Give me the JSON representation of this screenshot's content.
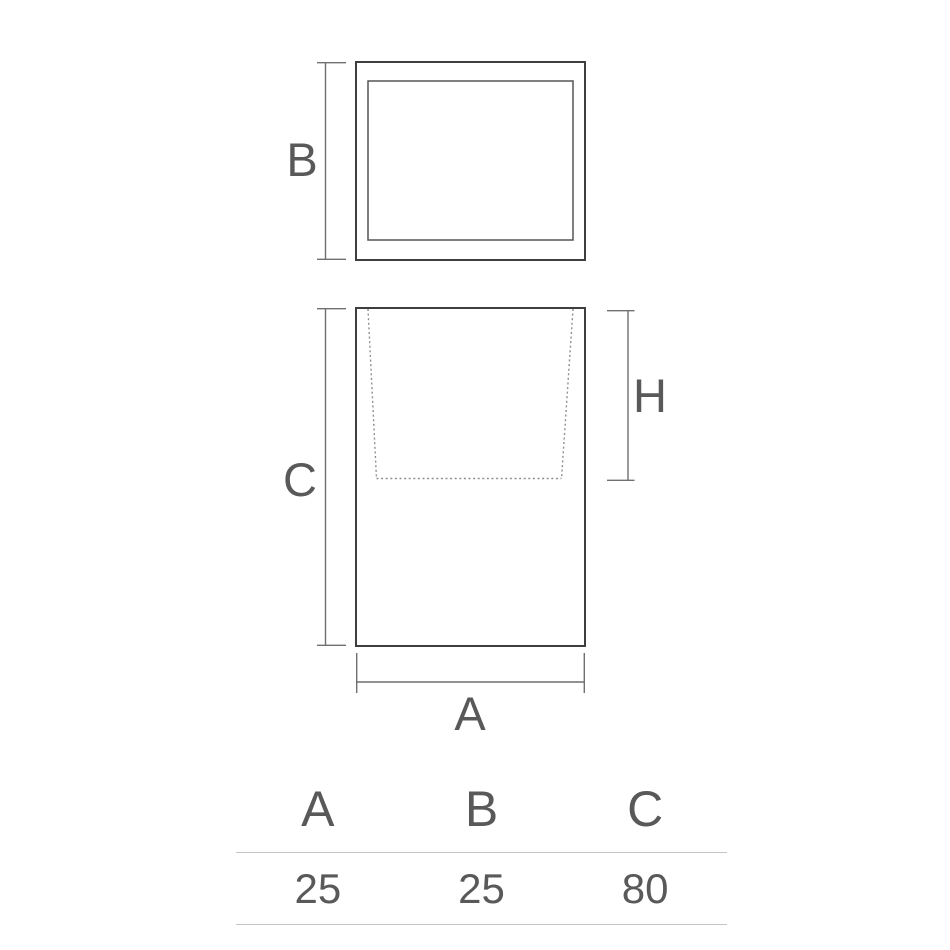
{
  "drawing": {
    "labels": {
      "top_depth": "B",
      "body_height": "C",
      "cavity_depth": "H",
      "body_width": "A"
    }
  },
  "table": {
    "headers": [
      "A",
      "B",
      "C"
    ],
    "rows": [
      [
        "25",
        "25",
        "80"
      ]
    ]
  },
  "colors": {
    "background": "#ffffff",
    "outline": "#3e3e3e",
    "dimension_line": "#6f6f6f",
    "dotted_line": "#8f8f8f",
    "label_text": "#595959",
    "table_rule": "#c4c4c4"
  }
}
